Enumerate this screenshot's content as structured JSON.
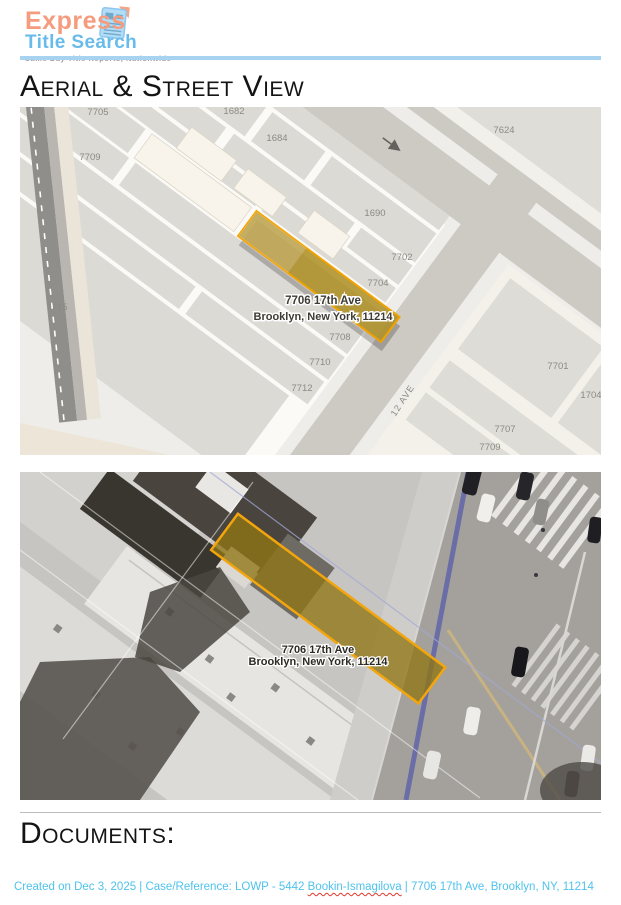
{
  "header": {
    "logo": {
      "title_part1": "Express",
      "title_part2": "Title Search",
      "tagline": "Same Day Title Reports, Nationwide",
      "colors": {
        "part1": "#F59C7E",
        "part2": "#69BBEA",
        "tagline": "#9E9E9E",
        "rule": "#A7D3F1"
      }
    }
  },
  "aerial_section": {
    "heading": "Aerial & Street View"
  },
  "documents_section": {
    "heading": "Documents:"
  },
  "parcel_map": {
    "subject_label": {
      "line1": "7706 17th Ave",
      "line2": "Brooklyn, New York, 11214"
    },
    "street_label": "12 AVE",
    "highlight": {
      "fill": "#B0922C",
      "stroke": "#F0A202"
    },
    "labels": [
      {
        "text": "7705"
      },
      {
        "text": "1682"
      },
      {
        "text": "7709"
      },
      {
        "text": "1684"
      },
      {
        "text": "1690"
      },
      {
        "text": "7702"
      },
      {
        "text": "7704"
      },
      {
        "text": "7708"
      },
      {
        "text": "7710"
      },
      {
        "text": "7712"
      },
      {
        "text": "7715"
      },
      {
        "text": "7624"
      },
      {
        "text": "7701"
      },
      {
        "text": "1704"
      },
      {
        "text": "7707"
      },
      {
        "text": "7709"
      }
    ]
  },
  "aerial_view": {
    "subject_label": {
      "line1": "7706 17th Ave",
      "line2": "Brooklyn, New York, 11214"
    },
    "highlight": {
      "fill": "#8F7614",
      "stroke": "#F2A50C"
    }
  },
  "footer": {
    "part1": "Created on Dec 3, 2025 | Case/Reference: LOWP - 5442 ",
    "case_name": "Bookin-Ismagilova",
    "part2": " | 7706 17th Ave, Brooklyn, NY, 11214",
    "color": "#4FC2EC"
  }
}
